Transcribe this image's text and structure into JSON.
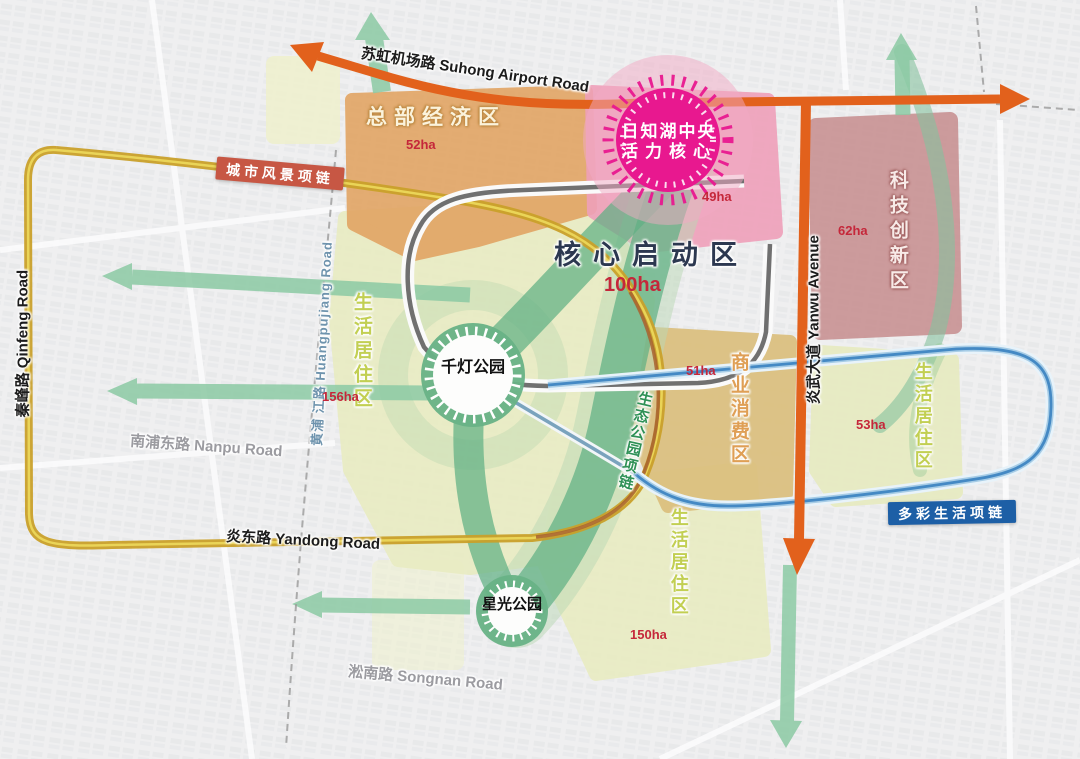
{
  "roads": {
    "suhong": "苏虹机场路 Suhong Airport Road",
    "qinfeng": "秦峰路 Qinfeng Road",
    "nanpu": "南浦东路 Nanpu Road",
    "huangpujiang": "黄浦 江路 Huangpujiang Road",
    "yandong": "炎东路 Yandong Road",
    "songnan": "淞南路 Songnan Road",
    "yanwu": "炎武大道 Yanwu Avenue"
  },
  "chains": {
    "city_scenery": "城市风景项链",
    "colorful_life": "多彩生活项链",
    "eco_park": "生态公园项链"
  },
  "zones": {
    "headquarters": {
      "name": "总部经济区",
      "area": "52ha"
    },
    "lake_core": {
      "line1": "日知湖中央",
      "line2": "活力核心",
      "area": "49ha"
    },
    "tech_innovation": {
      "name": "科技创新区",
      "area": "62ha"
    },
    "core_startup": {
      "name": "核心启动区",
      "area": "100ha"
    },
    "life_west": {
      "name": "生活居住区",
      "area": "156ha"
    },
    "commercial": {
      "name": "商业消费区",
      "area": "51ha"
    },
    "life_east": {
      "name": "生活居住区",
      "area": "53ha"
    },
    "life_south": {
      "name": "生活居住区",
      "area": "150ha"
    }
  },
  "parks": {
    "qiandeng": "千灯公园",
    "xingguang": "星光公园"
  },
  "colors": {
    "orange_road": "#e2611c",
    "gold_road": "#c9a02a",
    "blue_road": "#4489c4",
    "green_corridor": "#5fb083",
    "magenta_core": "#e8188f",
    "area_red": "#c5273a",
    "city_chain_bg": "#c75744",
    "colorful_chain_bg": "#1d5fa6"
  }
}
